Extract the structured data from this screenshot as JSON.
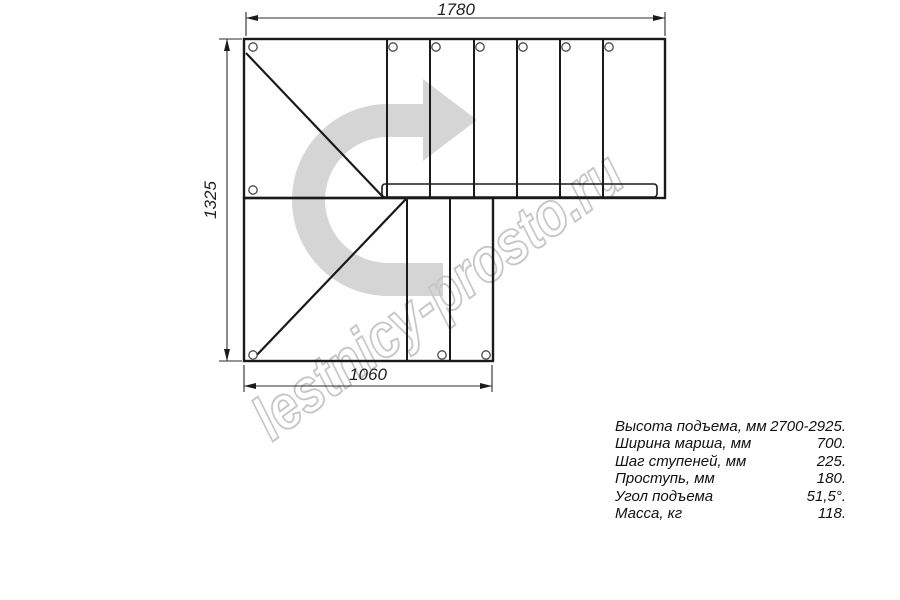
{
  "drawing": {
    "type": "staircase-plan-top-view",
    "watermark": "lestnicy-prosto.ru",
    "dimensions": {
      "top": "1780",
      "left": "1325",
      "bottom": "1060"
    },
    "colors": {
      "line": "#1a1a1a",
      "dimension_line": "#2b2b2b",
      "turn_arrow": "#d5d5d5",
      "watermark": "#c7c7c7"
    }
  },
  "specs": {
    "rows": [
      {
        "label": "Высота подъема, мм",
        "value": "2700-2925."
      },
      {
        "label": "Ширина марша, мм",
        "value": "700."
      },
      {
        "label": "Шаг ступеней, мм",
        "value": "225."
      },
      {
        "label": "Проступь, мм",
        "value": "180."
      },
      {
        "label": "Угол подъема",
        "value": "51,5°."
      },
      {
        "label": "Масса, кг",
        "value": "118."
      }
    ]
  }
}
